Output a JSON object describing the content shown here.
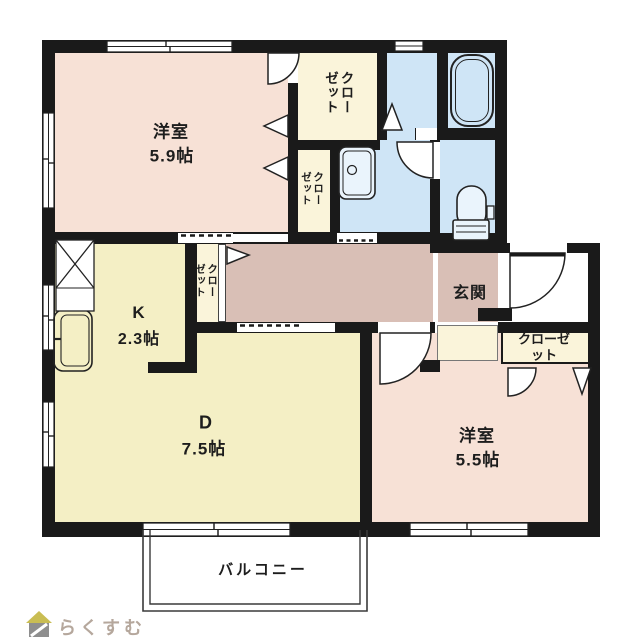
{
  "floorplan": {
    "title_note": "apartment floor plan",
    "rooms": {
      "western1": {
        "name": "洋室",
        "size": "5.9帖"
      },
      "kitchen": {
        "name": "K",
        "size": "2.3帖"
      },
      "dining": {
        "name": "D",
        "size": "7.5帖"
      },
      "western2": {
        "name": "洋室",
        "size": "5.5帖"
      },
      "entrance": {
        "name": "玄関"
      },
      "balcony": {
        "name": "バルコニー"
      }
    },
    "closets": {
      "top": {
        "label": "クローゼット"
      },
      "mid": {
        "label": "クローゼット"
      },
      "hall": {
        "label": "クローゼット"
      },
      "bedroom": {
        "label": "クローゼット"
      }
    },
    "fixtures": [
      "bathtub-icon",
      "toilet-icon",
      "washbasin-icon",
      "kitchen-sink-icon",
      "refrigerator-space-icon"
    ],
    "colors": {
      "wall": "#1a1a1a",
      "room_pink": "#f7e1d6",
      "room_yellow": "#f4efc5",
      "closet_cream": "#faf4da",
      "wet_area_blue": "#cfe5f6",
      "hall_mauve": "#d9bfb6",
      "balcony_line": "#3a3a3a",
      "logo": "#b5a79c"
    }
  },
  "footer": {
    "logo_text": "らくすむ"
  }
}
